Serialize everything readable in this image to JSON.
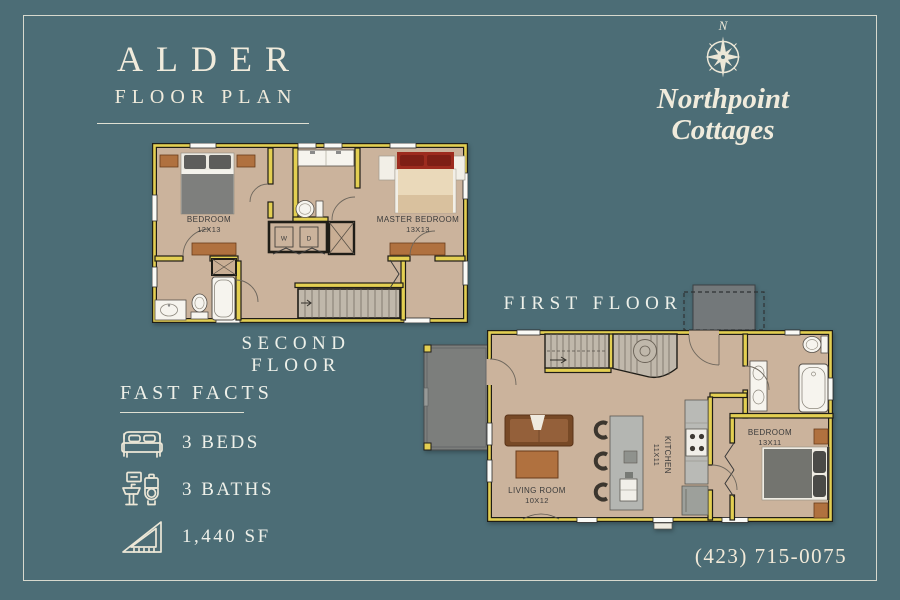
{
  "colors": {
    "background": "#4c6d76",
    "text_cream": "#f0ebdc",
    "wall": "#e3cf52",
    "floor": "#cbb39c",
    "plan_label": "#3b3b3b",
    "porch_gray": "#7c7e7c",
    "accent_red": "#9d2b1e",
    "wood": "#b0713f"
  },
  "header": {
    "title": "ALDER",
    "subtitle": "FLOOR PLAN"
  },
  "brand": {
    "compass_n": "N",
    "line1": "Northpoint",
    "line2": "Cottages"
  },
  "floors": {
    "second": {
      "label": "SECOND FLOOR",
      "rooms": {
        "bedroom": {
          "name": "BEDROOM",
          "dims": "12X13"
        },
        "master": {
          "name": "MASTER BEDROOM",
          "dims": "13X13"
        },
        "washer": "W",
        "dryer": "D"
      }
    },
    "first": {
      "label": "FIRST FLOOR",
      "rooms": {
        "living": {
          "name": "LIVING ROOM",
          "dims": "10X12"
        },
        "kitchen": {
          "name": "KITCHEN",
          "dims": "11X11"
        },
        "bedroom": {
          "name": "BEDROOM",
          "dims": "13X11"
        }
      }
    }
  },
  "fast_facts": {
    "title": "FAST FACTS",
    "items": [
      {
        "icon": "bed-icon",
        "label": "3 BEDS"
      },
      {
        "icon": "bath-icon",
        "label": "3 BATHS"
      },
      {
        "icon": "area-icon",
        "label": "1,440 SF"
      }
    ]
  },
  "contact": {
    "phone": "(423) 715-0075"
  }
}
